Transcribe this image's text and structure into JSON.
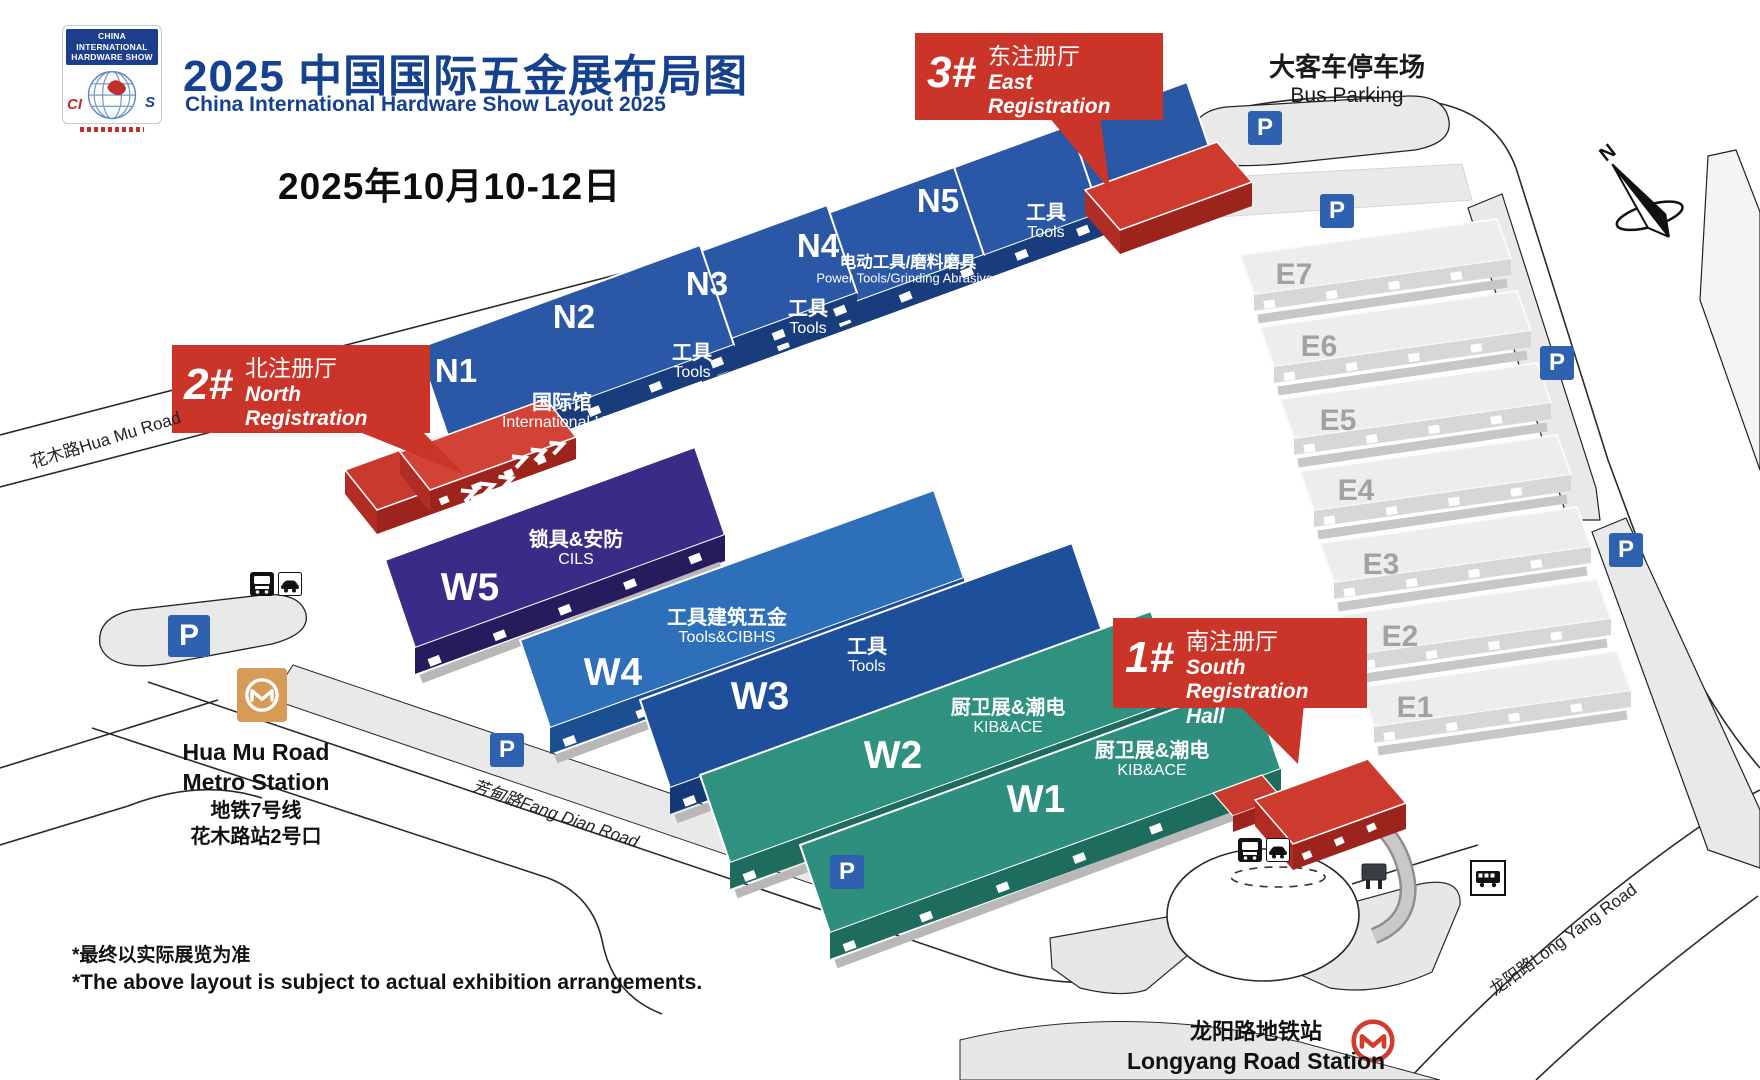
{
  "header": {
    "logo": {
      "line1": "CHINA INTERNATIONAL",
      "line2": "HARDWARE SHOW",
      "acronym_left": "CI",
      "acronym_right": "S"
    },
    "title": "2025 中国国际五金展布局图",
    "subtitle": "China International Hardware  Show Layout 2025",
    "date": "2025年10月10-12日"
  },
  "callouts": [
    {
      "num": "1#",
      "zh": "南注册厅",
      "en_line1": "South Registration",
      "en_line2": "Hall"
    },
    {
      "num": "2#",
      "zh": "北注册厅",
      "en_line1": "North Registration",
      "en_line2": "Hall"
    },
    {
      "num": "3#",
      "zh": "东注册厅",
      "en_line1": "East Registration",
      "en_line2": "Hall"
    }
  ],
  "halls": {
    "n1": {
      "code": "N1",
      "zh": "国际馆",
      "en": "International Hall"
    },
    "n2": {
      "code": "N2",
      "zh": "工具",
      "en": "Tools"
    },
    "n3": {
      "code": "N3",
      "zh": "工具",
      "en": "Tools"
    },
    "n4": {
      "code": "N4",
      "zh": "电动工具/磨料磨具",
      "en": "Power Tools/Grinding Abrasives"
    },
    "n5": {
      "code": "N5",
      "zh": "工具",
      "en": "Tools"
    },
    "w1": {
      "code": "W1",
      "zh": "厨卫展&潮电",
      "en": "KIB&ACE"
    },
    "w2": {
      "code": "W2",
      "zh": "厨卫展&潮电",
      "en": "KIB&ACE"
    },
    "w3": {
      "code": "W3",
      "zh": "工具",
      "en": "Tools"
    },
    "w4": {
      "code": "W4",
      "zh": "工具建筑五金",
      "en": "Tools&CIBHS"
    },
    "w5": {
      "code": "W5",
      "zh": "锁具&安防",
      "en": "CILS"
    },
    "e1": {
      "code": "E1"
    },
    "e2": {
      "code": "E2"
    },
    "e3": {
      "code": "E3"
    },
    "e4": {
      "code": "E4"
    },
    "e5": {
      "code": "E5"
    },
    "e6": {
      "code": "E6"
    },
    "e7": {
      "code": "E7"
    }
  },
  "map_labels": {
    "bus_parking_zh": "大客车停车场",
    "bus_parking_en": "Bus Parking",
    "parking_sign": "P",
    "compass_north": "N",
    "road_huamu": "花木路Hua Mu Road",
    "road_fangdian": "芳甸路Fang Dian Road",
    "road_longyang": "龙阳路Long Yang Road",
    "huamu_station_en1": "Hua Mu Road",
    "huamu_station_en2": "Metro Station",
    "huamu_station_zh1": "地铁7号线",
    "huamu_station_zh2": "花木路站2号口",
    "longyang_station_zh": "龙阳路地铁站",
    "longyang_station_en": "Longyang  Road Station"
  },
  "footnotes": {
    "zh": "*最终以实际展览为准",
    "en": "*The above layout is subject to actual exhibition arrangements."
  },
  "colors": {
    "brand_blue": "#15418e",
    "callout_red": "#cb3428",
    "n_hall": "#2b58a6",
    "w4_hall": "#2e6fba",
    "w3_hall": "#1e4f9a",
    "w5_hall": "#3b2b87",
    "teal_hall": "#2f8f7e",
    "e_hall": "#ededed",
    "parking_blue": "#2e62b0",
    "metro_orange": "#d79a57",
    "metro_red": "#d23b2e"
  }
}
